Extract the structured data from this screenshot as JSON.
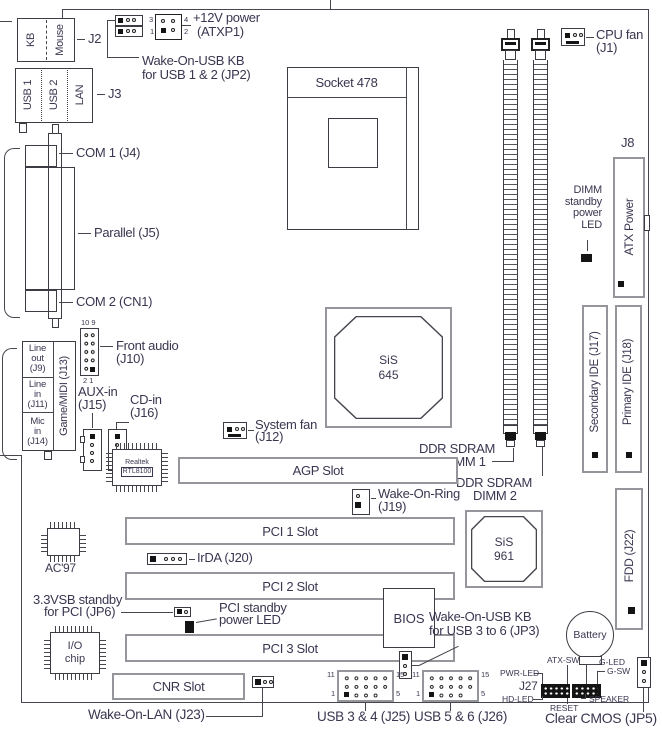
{
  "colors": {
    "text": "#3b3650",
    "line": "#46464e",
    "slot_border": "#95959c",
    "black": "#141414"
  },
  "top": {
    "jp2_line1": "Wake-On-USB KB",
    "jp2_line2": "for USB 1 & 2 (JP2)",
    "atxp1_line1": "+12V power",
    "atxp1_line2": "(ATXP1)",
    "atxp1_pin3": "3",
    "atxp1_pin4": "4",
    "atxp1_pin1": "1",
    "atxp1_pin2": "2",
    "cpu_fan_line1": "CPU fan",
    "cpu_fan_line2": "(J1)"
  },
  "back_panel": {
    "j2": "J2",
    "kb": "KB",
    "mouse": "Mouse",
    "j3": "J3",
    "usb1": "USB 1",
    "usb2": "USB 2",
    "lan": "LAN",
    "com1": "COM 1 (J4)",
    "parallel": "Parallel (J5)",
    "com2": "COM 2 (CN1)",
    "line_out": [
      "Line",
      "out",
      "(J9)"
    ],
    "line_in": [
      "Line",
      "in",
      "(J11)"
    ],
    "mic_in": [
      "Mic",
      "in",
      "(J14)"
    ],
    "game_midi": "Game/MIDI (J13)"
  },
  "audio": {
    "front_line1": "Front audio",
    "front_line2": "(J10)",
    "front_pins_top": "10 9",
    "front_pins_bottom": "2 1",
    "aux_line1": "AUX-in",
    "aux_line2": "(J15)",
    "cd_line1": "CD-in",
    "cd_line2": "(J16)"
  },
  "chips": {
    "socket": "Socket 478",
    "sis645_line1": "SiS",
    "sis645_line2": "645",
    "sis961_line1": "SiS",
    "sis961_line2": "961",
    "realtek_line1": "Realtek",
    "realtek_line2": "RTL8100",
    "ac97": "AC'97",
    "io_line1": "I/O",
    "io_line2": "chip",
    "bios": "BIOS"
  },
  "memory": {
    "ddr1_line1": "DDR SDRAM",
    "ddr1_line2": "DIMM 1",
    "ddr2_line1": "DDR SDRAM",
    "ddr2_line2": "DIMM 2",
    "dimm_led": [
      "DIMM",
      "standby",
      "power",
      "LED"
    ]
  },
  "right_side": {
    "j8": "J8",
    "atx_power": "ATX Power",
    "secondary_ide": "Secondary IDE (J17)",
    "primary_ide": "Primary IDE (J18)",
    "fdd": "FDD (J22)",
    "battery": "Battery"
  },
  "fans": {
    "system_line1": "System fan",
    "system_line2": "(J12)"
  },
  "slots": {
    "agp": "AGP Slot",
    "pci1": "PCI 1 Slot",
    "pci2": "PCI 2 Slot",
    "pci3": "PCI 3 Slot",
    "cnr": "CNR Slot"
  },
  "connectors": {
    "wor_line1": "Wake-On-Ring",
    "wor_line2": "(J19)",
    "irda": "IrDA (J20)",
    "jp6_line1": "3.3VSB standby",
    "jp6_line2": "for PCI (JP6)",
    "pci_led_line1": "PCI standby",
    "pci_led_line2": "power LED",
    "jp3_line1": "Wake-On-USB KB",
    "jp3_line2": "for USB 3 to 6 (JP3)",
    "wol": "Wake-On-LAN (J23)",
    "usb34": "USB 3 & 4 (J25)",
    "usb56": "USB 5 & 6 (J26)",
    "clear_cmos": "Clear CMOS (JP5)",
    "pin11": "11",
    "pin15": "15",
    "pin1": "1",
    "pin5": "5"
  },
  "front_panel": {
    "j27": "J27",
    "atx_sw": "ATX-SW",
    "g_led": "G-LED",
    "g_sw": "G-SW",
    "pwr_led": "PWR-LED",
    "hd_led": "HD-LED",
    "reset": "RESET",
    "speaker": "SPEAKER"
  }
}
